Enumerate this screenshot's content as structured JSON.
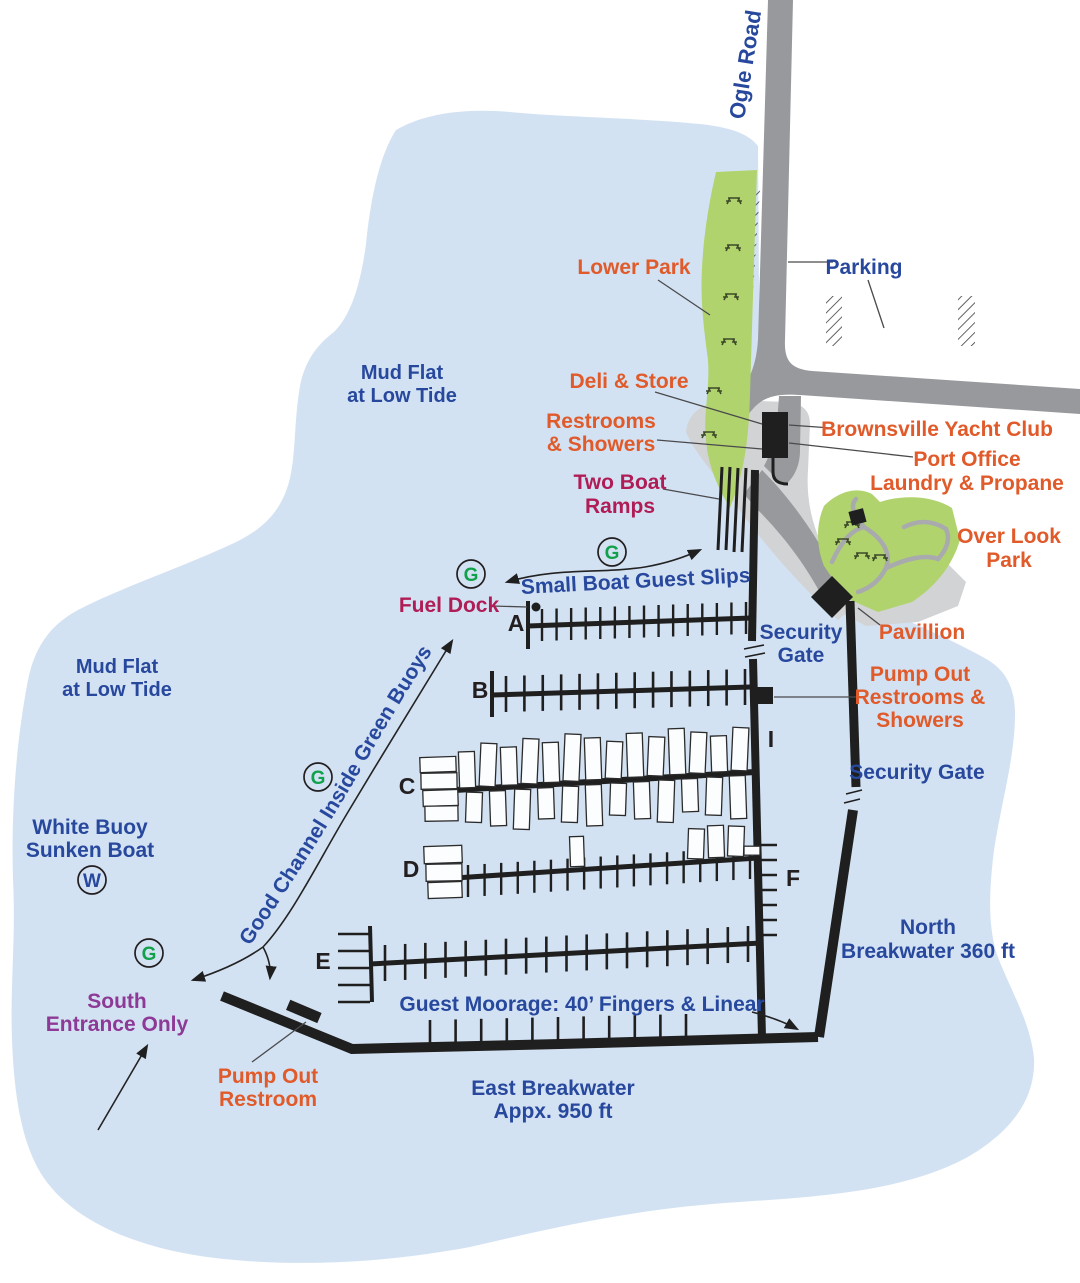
{
  "colors": {
    "water": "#d3e2f3",
    "road_gray": "#97999c",
    "apron_gray": "#d2d3d5",
    "park_green": "#b0d36e",
    "path_gray": "#a8aaad",
    "label_blue": "#27489d",
    "label_orange": "#e05a2a",
    "label_crimson": "#b01d56",
    "label_purple": "#8d3996",
    "marker_green": "#12a14b",
    "dock_black": "#1f1f1f"
  },
  "labels": {
    "ogle_road": "Ogle Road",
    "parking": "Parking",
    "lower_park": "Lower Park",
    "mud_flat_top_line1": "Mud Flat",
    "mud_flat_top_line2": "at Low Tide",
    "mud_flat_left_line1": "Mud Flat",
    "mud_flat_left_line2": "at Low Tide",
    "deli_store": "Deli & Store",
    "restrooms_line1": "Restrooms",
    "restrooms_line2": "& Showers",
    "two_boat_ramps_line1": "Two Boat",
    "two_boat_ramps_line2": "Ramps",
    "brownsville_yacht_club": "Brownsville Yacht Club",
    "port_office_line1": "Port Office",
    "port_office_line2": "Laundry & Propane",
    "over_look_park_line1": "Over Look",
    "over_look_park_line2": "Park",
    "fuel_dock": "Fuel Dock",
    "small_boat_guest_slips": "Small Boat Guest Slips",
    "security_gate_upper_line1": "Security",
    "security_gate_upper_line2": "Gate",
    "pavillion": "Pavillion",
    "pump_out_rs_line1": "Pump Out",
    "pump_out_rs_line2": "Restrooms &",
    "pump_out_rs_line3": "Showers",
    "security_gate_lower": "Security Gate",
    "good_channel": "Good Channel Inside Green Buoys",
    "white_buoy_line1": "White Buoy",
    "white_buoy_line2": "Sunken Boat",
    "north_breakwater_line1": "North",
    "north_breakwater_line2": "Breakwater 360 ft",
    "south_entrance_line1": "South",
    "south_entrance_line2": "Entrance Only",
    "guest_moorage": "Guest Moorage: 40’ Fingers & Linear",
    "pump_out_restroom_line1": "Pump Out",
    "pump_out_restroom_line2": "Restroom",
    "east_breakwater_line1": "East Breakwater",
    "east_breakwater_line2": "Appx. 950 ft"
  },
  "docks": {
    "a": "A",
    "b": "B",
    "c": "C",
    "d": "D",
    "e": "E",
    "f": "F",
    "i": "I"
  },
  "markers": {
    "green_buoy": "G",
    "white_buoy": "W"
  }
}
